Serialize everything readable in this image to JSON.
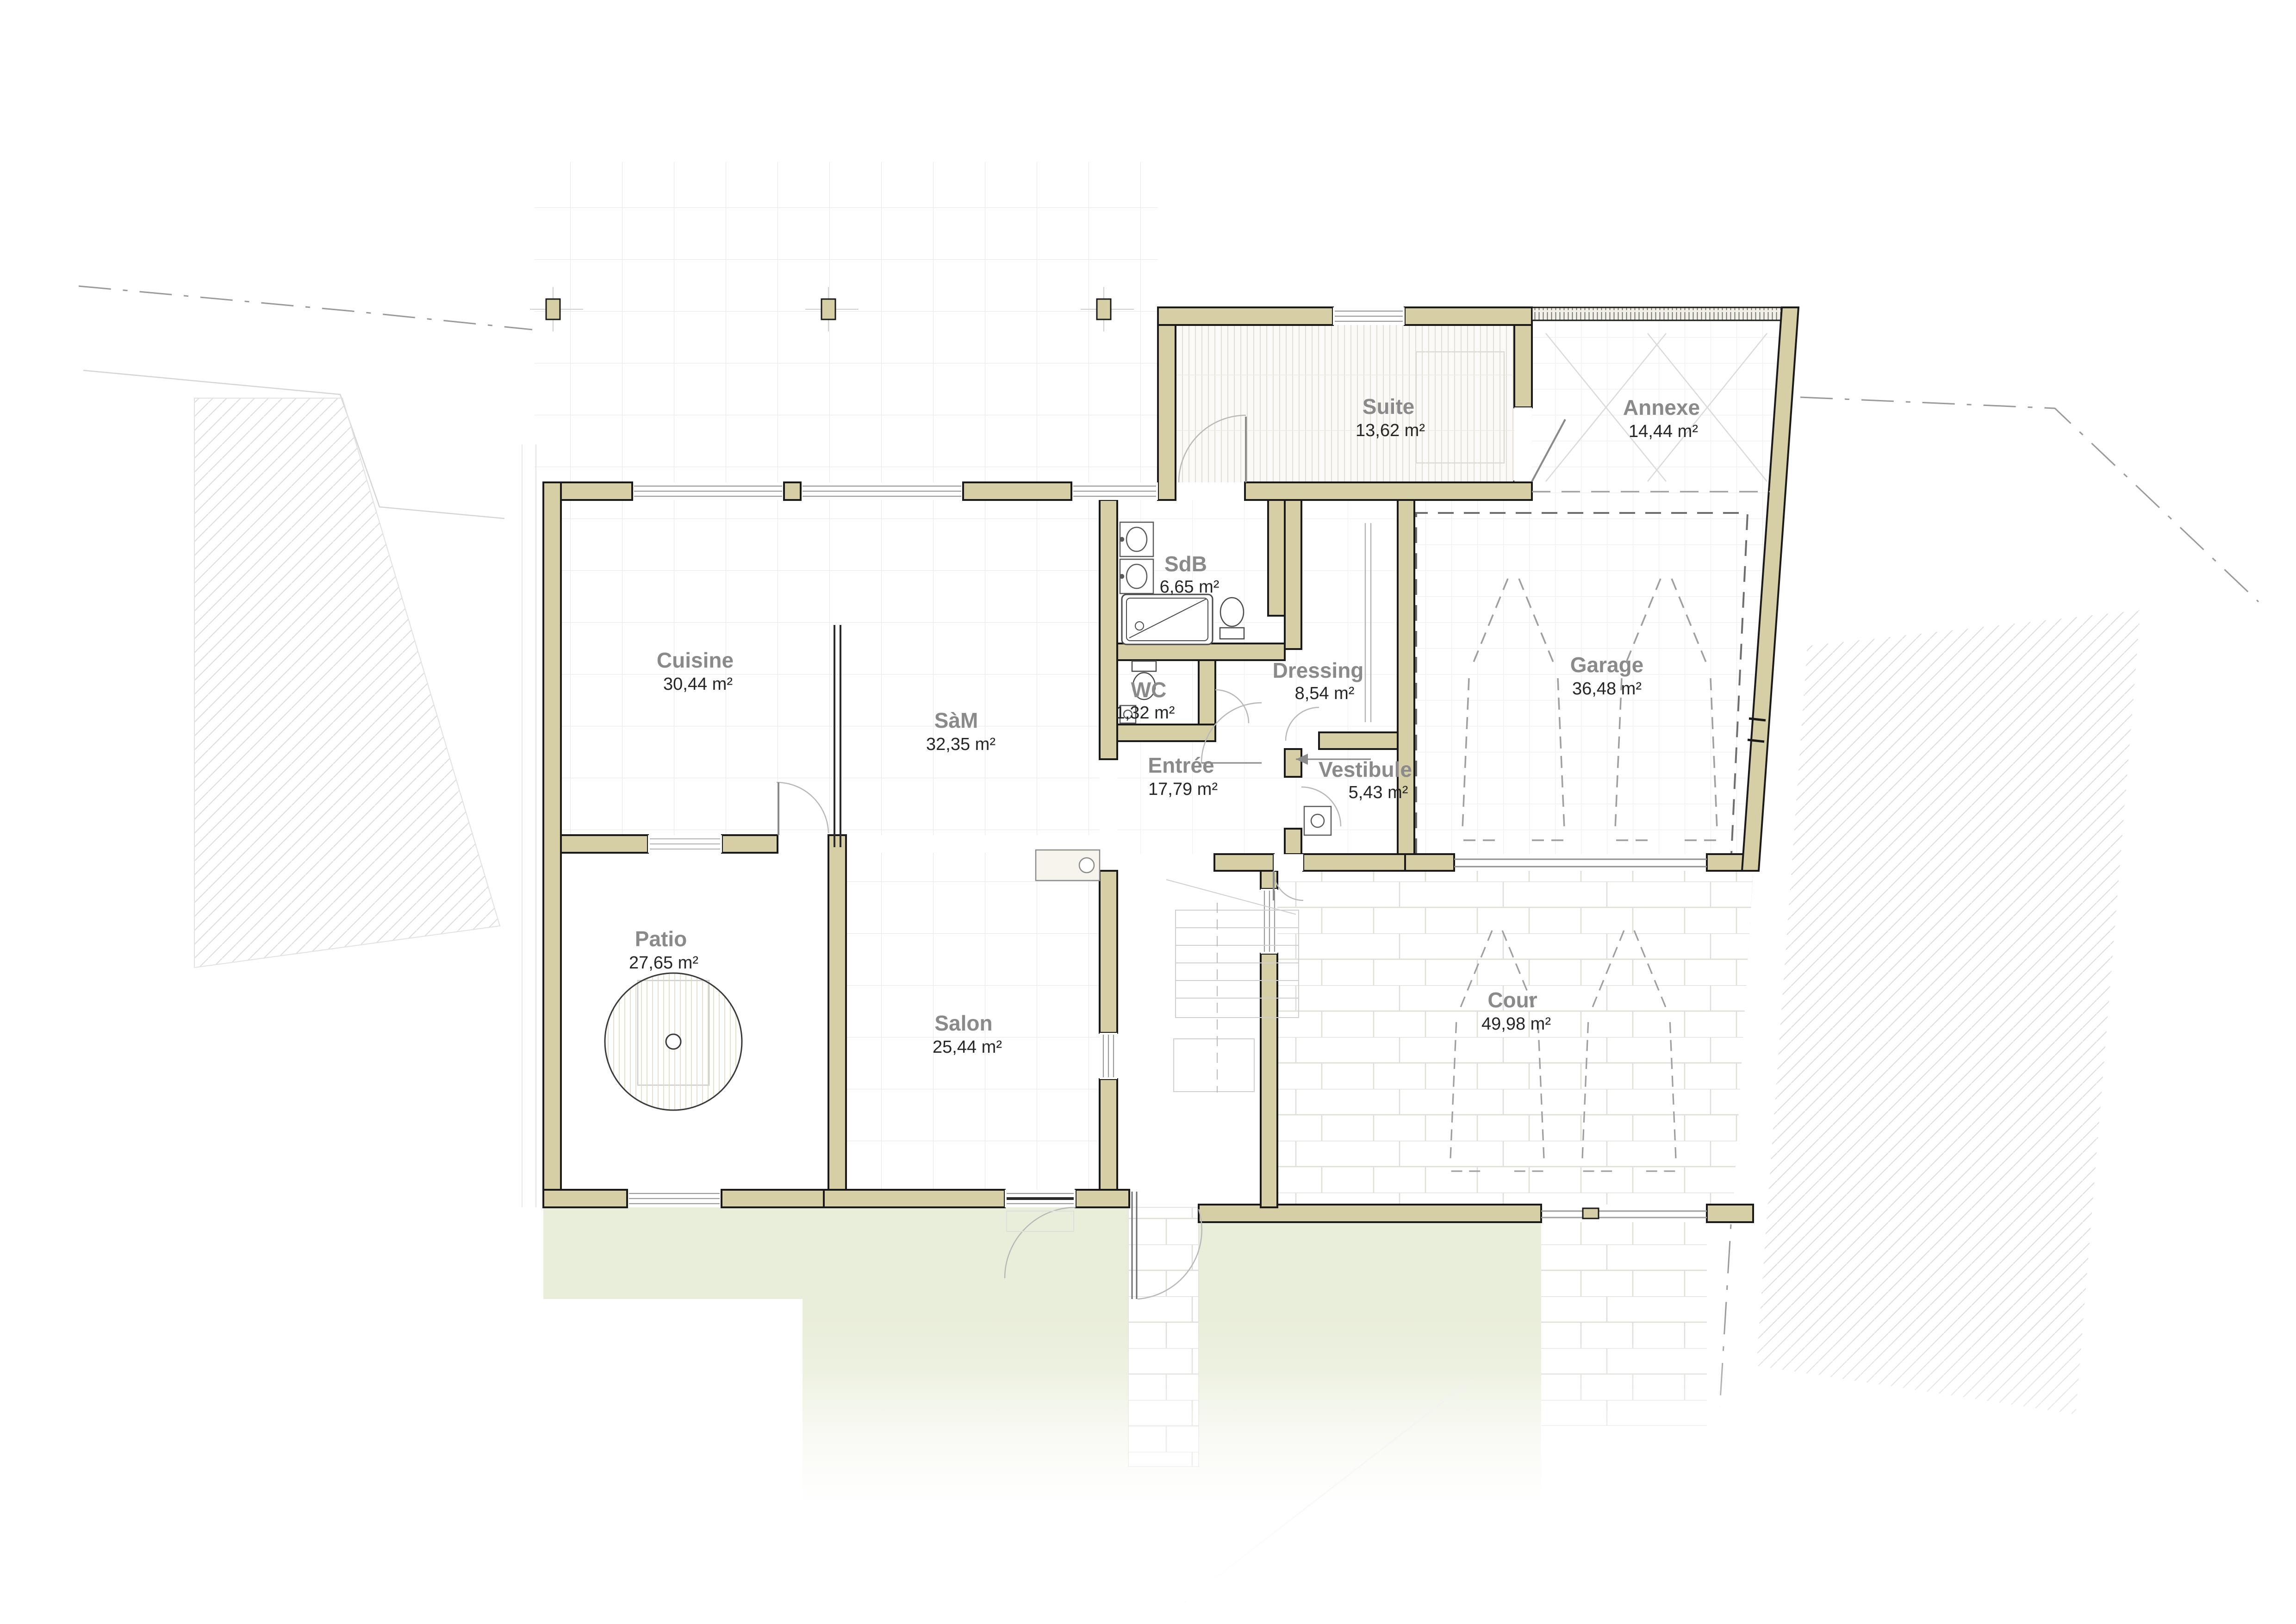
{
  "plan": {
    "type": "architectural-floor-plan",
    "rooms": [
      {
        "name": "Cuisine",
        "area": "30,44 m²"
      },
      {
        "name": "SàM",
        "area": "32,35 m²"
      },
      {
        "name": "Salon",
        "area": "25,44 m²"
      },
      {
        "name": "Patio",
        "area": "27,65 m²"
      },
      {
        "name": "Entrée",
        "area": "17,79 m²"
      },
      {
        "name": "SdB",
        "area": "6,65 m²"
      },
      {
        "name": "WC",
        "area": "1,32 m²"
      },
      {
        "name": "Dressing",
        "area": "8,54 m²"
      },
      {
        "name": "Vestibule",
        "area": "5,43 m²"
      },
      {
        "name": "Suite",
        "area": "13,62 m²"
      },
      {
        "name": "Annexe",
        "area": "14,44 m²"
      },
      {
        "name": "Garage",
        "area": "36,48 m²"
      },
      {
        "name": "Cour",
        "area": "49,98 m²"
      }
    ],
    "colors": {
      "wall_fill": "#d6cfa6",
      "wall_outline": "#1a1a1a",
      "room_label": "#8a8a8a",
      "area_text": "#262626",
      "garden_green": "#e9eeda",
      "grid_line": "#e7e7e3",
      "brick_line": "#e0ddd7",
      "hatch_line": "#dcdcdc",
      "dash_line": "#9a9a9a"
    }
  }
}
